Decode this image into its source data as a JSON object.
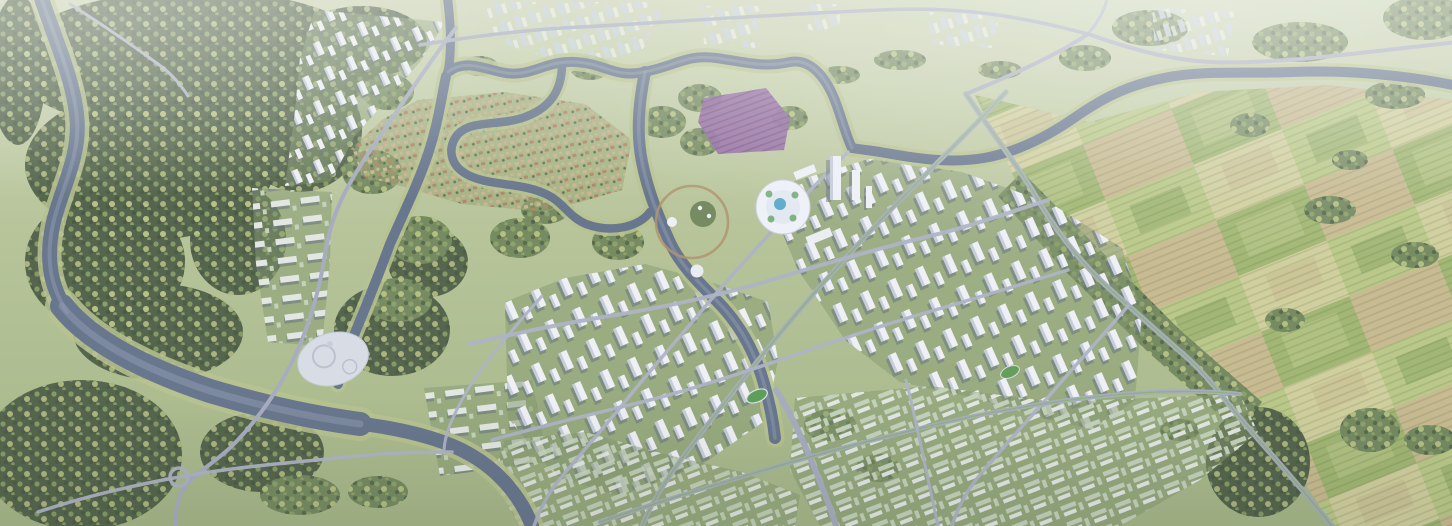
{
  "scene": {
    "type": "aerial-render",
    "subject": "planned-city-masterplan-model",
    "regions": [
      "forest-west",
      "river-network",
      "old-town-village",
      "flower-field",
      "civic-landmark",
      "high-rise-district-east",
      "high-rise-district-south",
      "row-housing-southeast",
      "office-campus",
      "hillside-housing-strip",
      "riverside-housing-cluster",
      "distant-city-skyline",
      "farmland-east",
      "event-plaza",
      "perimeter-highway",
      "island-ring"
    ]
  },
  "palette": {
    "base_top": "#c9d3b0",
    "base_bottom": "#a2b383",
    "forest_dark": "#4d5e44",
    "forest_mid": "#6f855a",
    "tree_a": "#8fa566",
    "tree_b": "#c9d38b",
    "tree_c": "#3e4e37",
    "water": "#617089",
    "water_light": "#8b96ac",
    "bank": "#b5c18b",
    "road": "#aab0c3",
    "road_major": "#a3a9bd",
    "road_median": "#86b069",
    "tower_face": "#eef1f6",
    "tower_side": "#c4cbda",
    "tower_shadow": "#5d6879",
    "tower_far": "#c3d0e0",
    "slab": "#e2e7e4",
    "slab_green": "#c2d0b8",
    "oldtown": "#c8b28b",
    "oldtown_roof": "#ad8160",
    "purple": "#8e61a0",
    "purple_dark": "#6c4a7e",
    "farm_a": "#b7c783",
    "farm_b": "#9eb46d",
    "farm_c": "#cfce9a",
    "farm_d": "#c6b88c",
    "farm_e": "#88a35f",
    "landmark": "#eef2f8",
    "pool": "#58a7c8",
    "plaza": "#d7dbe4",
    "pitch": "#569a52",
    "ring": "#ae8f68",
    "haze": "#e8edf2"
  }
}
